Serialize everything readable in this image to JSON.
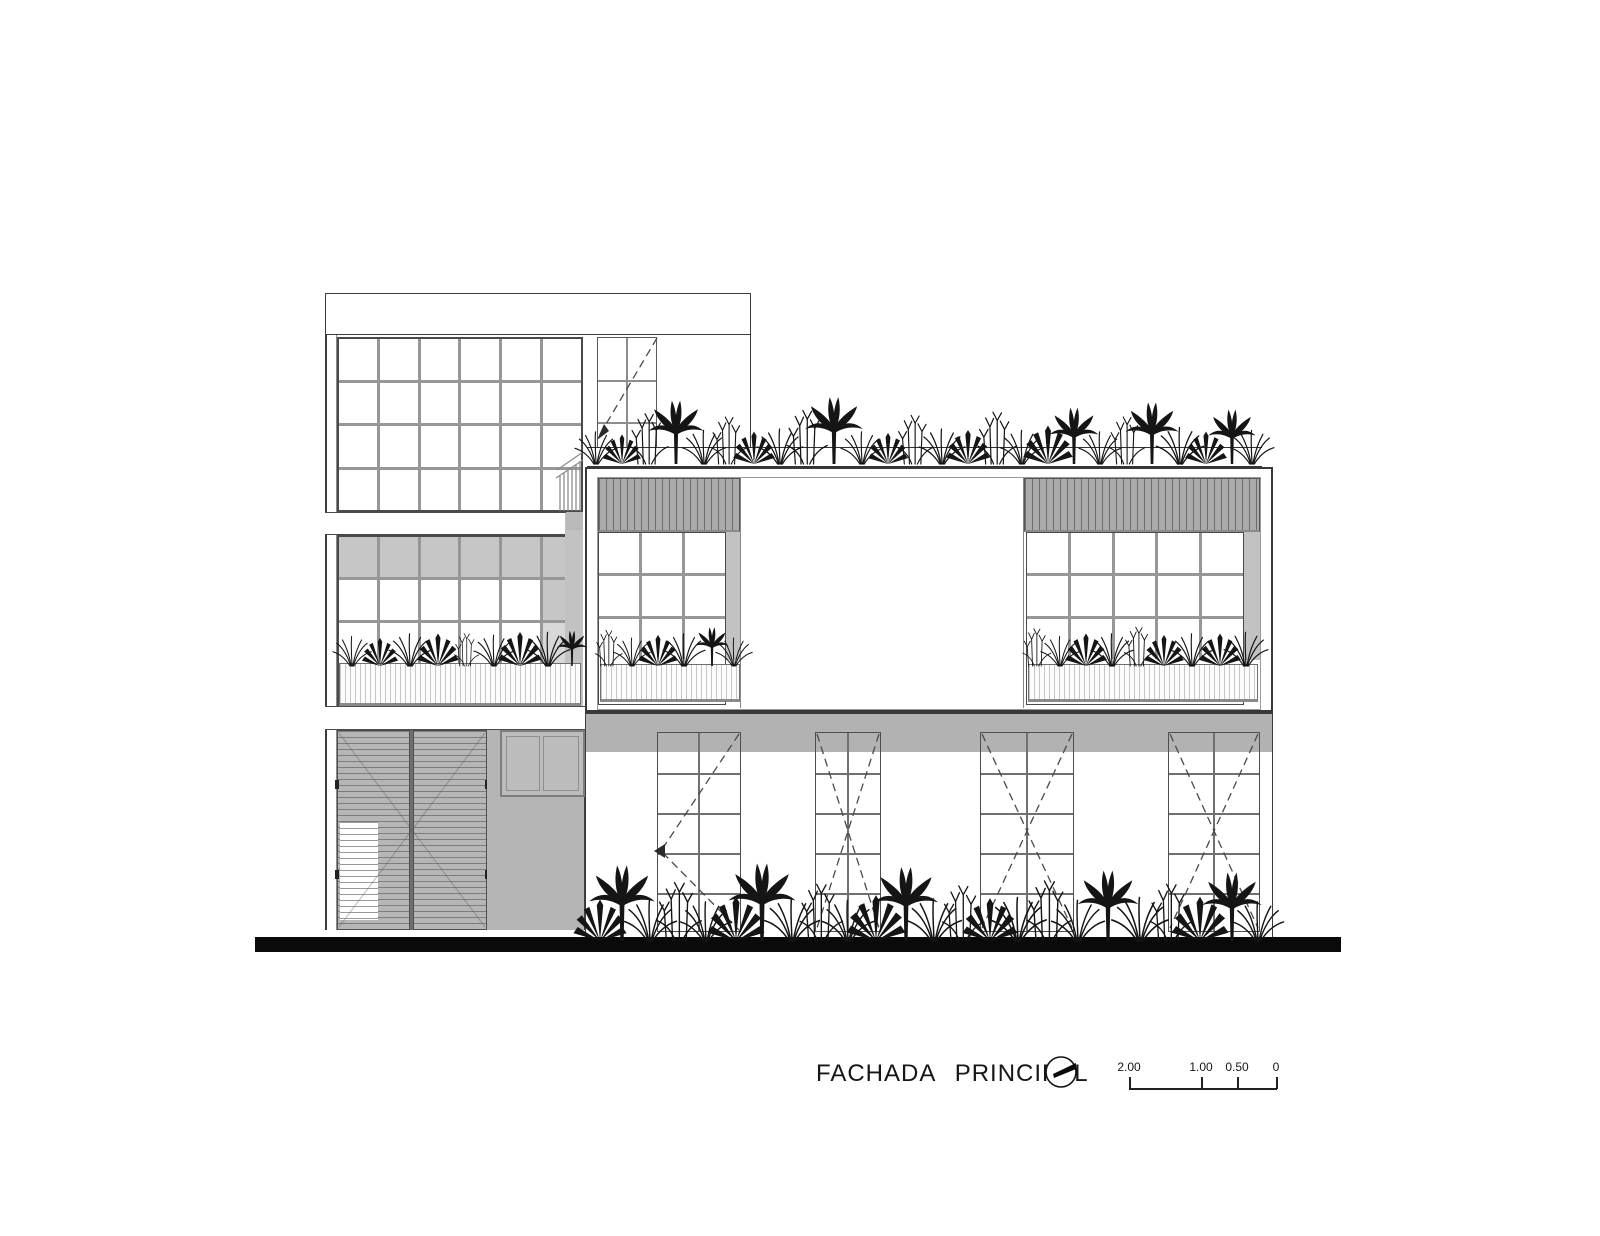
{
  "sheet": {
    "background": "#ffffff",
    "ink_color": "#3c3c3c",
    "shadow_gray": "#b3b3b3",
    "ground_bar_color": "#0a0a0a"
  },
  "annotation": {
    "title": "FACHADA PRINCIPAL",
    "marker_icon": "section-marker-circle-with-hand",
    "scale_bar": {
      "labels": [
        "2.00",
        "1.00",
        "0.50",
        "0"
      ]
    }
  }
}
